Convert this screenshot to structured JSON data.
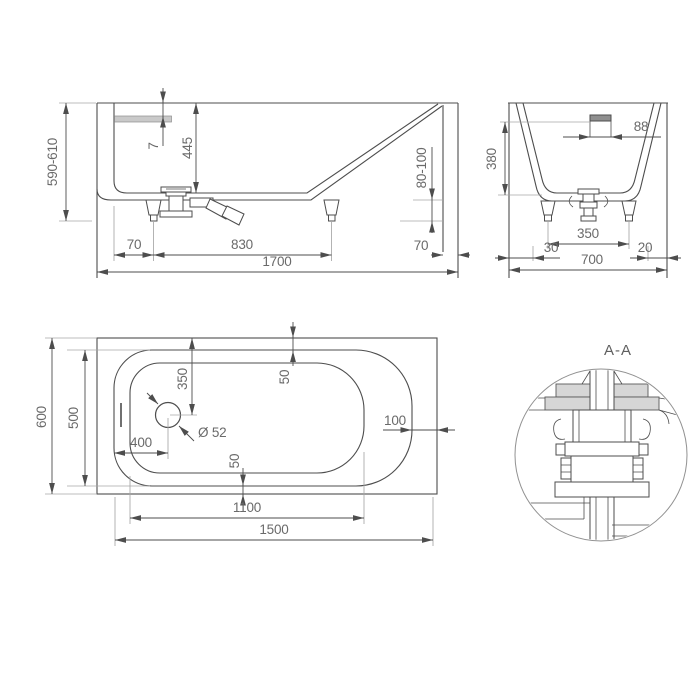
{
  "drawing": {
    "detail_label": "A-A",
    "side_view": {
      "dim_height_range": "590-610",
      "dim_rim_drop": "7",
      "dim_inner_depth": "445",
      "dim_foot_height": "80-100",
      "dim_left_foot_offset": "70",
      "dim_foot_spacing": "830",
      "dim_right_foot_offset": "70",
      "dim_overall_length": "1700"
    },
    "end_view": {
      "dim_overflow_width": "88",
      "dim_inner_depth": "380",
      "dim_foot_spacing": "350",
      "dim_left_offset": "30",
      "dim_overall_width": "700",
      "dim_right_offset": "20"
    },
    "top_view": {
      "dim_overall_width": "600",
      "dim_inner_width": "500",
      "dim_drain_offset_top": "350",
      "dim_rim_gap_top": "50",
      "dim_drain_offset_left": "400",
      "dim_drain_diameter": "Ø 52",
      "dim_rim_gap_bottom": "50",
      "dim_rim_gap_right": "100",
      "dim_floor_length": "1100",
      "dim_overall_length": "1500"
    },
    "colors": {
      "line": "#4d4d4d",
      "extension": "#a6a6a6",
      "text": "#6a6a6a",
      "shade": "#d6d6d6",
      "background": "#ffffff"
    }
  }
}
